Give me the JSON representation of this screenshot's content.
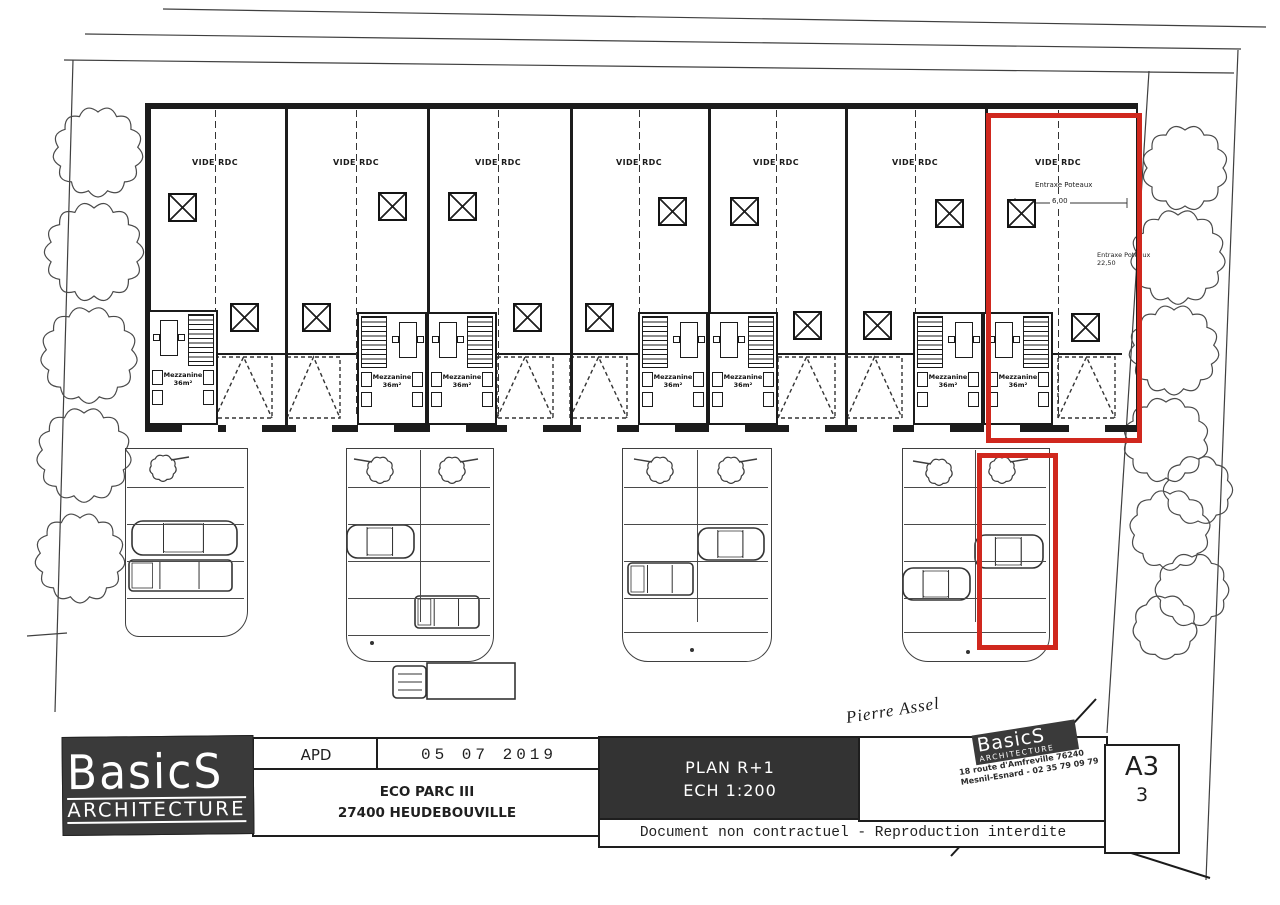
{
  "plan": {
    "vide_rdc_label": "VIDE RDC",
    "mezzanine_label": "Mezzanine",
    "mezzanine_area_label": "36m²",
    "entraxe_label": "Entraxe Poteaux",
    "entraxe_value": "6,00",
    "right_entraxe_label": "Entraxe Poteaux",
    "right_entraxe_value": "22,50"
  },
  "title_block": {
    "logo_line1": "BasicS",
    "logo_line2": "ARCHITECTURE",
    "phase": "APD",
    "date": "05 07 2019",
    "project_line1": "ECO PARC III",
    "project_line2": "27400 HEUDEBOUVILLE",
    "plan_title_line1": "PLAN R+1",
    "plan_title_line2": "ECH 1:200",
    "disclaimer": "Document non contractuel - Reproduction interdite",
    "signature": "Pierre Assel",
    "stamp": {
      "name": "BasicS",
      "sub": "ARCHITECTURE",
      "address": "18 route d'Amfreville 76240",
      "city_phone": "Mesnil-Esnard - 02 35 79 09 79"
    },
    "format": "A3",
    "sheet": "3"
  },
  "colors": {
    "highlight_red": "#d0281e",
    "ink": "#1f1f1f",
    "panel_dark": "#3a3a3a"
  }
}
